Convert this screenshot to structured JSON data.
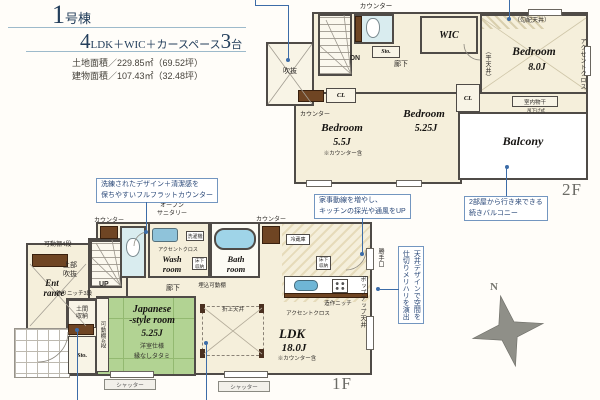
{
  "header": {
    "building_num": "1",
    "building_suffix": "号棟",
    "layout_num": "4",
    "layout_text": "LDK＋WIC＋カースペース",
    "layout_count": "3",
    "layout_unit": "台",
    "land_area": "土地面積／229.85㎡（69.52坪）",
    "building_area": "建物面積／107.43㎡（32.48坪）"
  },
  "floor2": {
    "floor_label": "2F",
    "labels": {
      "counter_top": "カウンター",
      "sto": "Sto.",
      "dn": "DN",
      "hallway": "廊下",
      "wic": "WIC",
      "sloped_ceiling": "（勾配天井）",
      "flat_ceiling": "（平天井）",
      "accent_cross": "アクセントクロス",
      "bedroom8_name": "Bedroom",
      "bedroom8_size": "8.0J",
      "indoor_drying": "室内物干",
      "drying_type": "吊下げ式",
      "cl_left": "CL",
      "cl_right": "CL",
      "void": "吹抜",
      "counter_bed55": "カウンター",
      "bedroom55_name": "Bedroom",
      "bedroom55_size": "5.5J",
      "bedroom55_note": "※カウンター含",
      "bedroom525_name": "Bedroom",
      "bedroom525_size": "5.25J",
      "balcony": "Balcony"
    }
  },
  "floor1": {
    "floor_label": "1F",
    "labels": {
      "counter_wc": "カウンター",
      "movable_shelf": "可動棚4段",
      "upper_void": "上部吹抜",
      "up": "UP",
      "niche": "飾りニッチ3段",
      "entrance_l1": "Ent",
      "entrance_l2": "rance",
      "doma": "土間収納",
      "sto": "Sto.",
      "closet_shelf": "可動棚4段",
      "jroom_l1": "Japanese",
      "jroom_l2": "-style room",
      "jroom_size": "5.25J",
      "jroom_note1": "洋室仕様",
      "jroom_note2": "縁なしタタミ",
      "shutter_left": "シャッター",
      "shutter_right": "シャッター",
      "open_sanitary_l1": "オープン",
      "open_sanitary_l2": "サニタリー",
      "accent_wash": "アクセントクロス",
      "washer": "洗濯機",
      "wash_l1": "Wash",
      "wash_l2": "room",
      "underfloor_wash": "床下収納",
      "bath_l1": "Bath",
      "bath_l2": "room",
      "counter_kitchen": "カウンター",
      "fridge": "冷蔵庫",
      "underfloor_kitchen": "床下収納",
      "built_in_shelf": "埋込可動棚",
      "hallway": "廊下",
      "back_door": "勝手口",
      "popup_ceiling": "ポップアップ天井",
      "custom_niche": "造作ニッチ",
      "accent_kitchen": "アクセントクロス",
      "ldk_name": "LDK",
      "ldk_size": "18.0J",
      "ldk_note": "※カウンター含",
      "coffered_ceiling": "折上天井"
    }
  },
  "callouts": {
    "flat_counter_l1": "洗練されたデザイン＋清潔感を",
    "flat_counter_l2": "保ちやすいフルフラットカウンター",
    "housework_l1": "家事動線を増やし、",
    "housework_l2": "キッチンの採光や通風をUP",
    "balcony_l1": "2部屋から行き来できる",
    "balcony_l2": "続きバルコニー",
    "ceiling_l1": "天井デザインで空間を",
    "ceiling_l2": "仕切りメリハリを演出"
  },
  "compass": {
    "north": "N"
  },
  "colors": {
    "accent_blue": "#3c6ca8",
    "wall": "#4f4b47",
    "floor_cream": "#f5efdb",
    "tatami_green": "#b2d393",
    "water_blue": "#cfe6ea",
    "counter_brown": "#6f4523"
  }
}
